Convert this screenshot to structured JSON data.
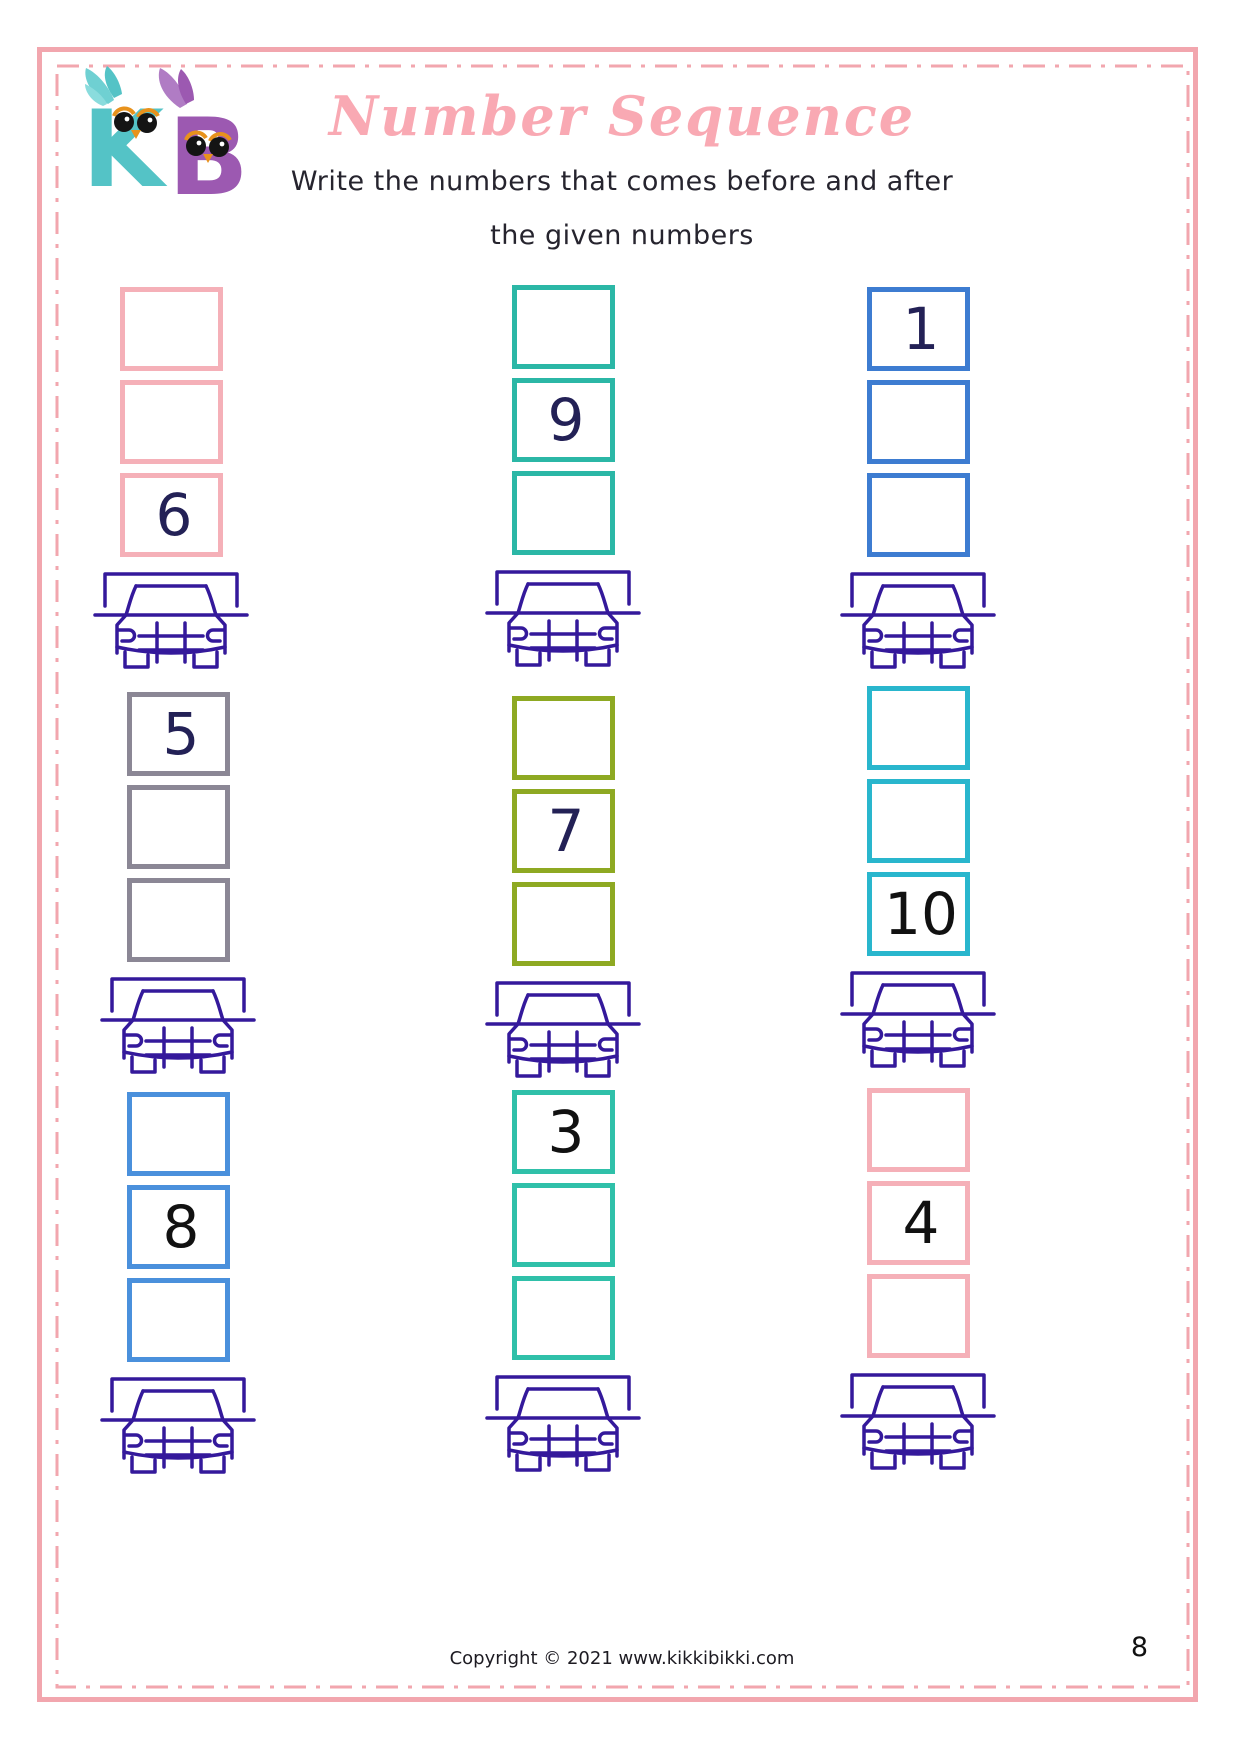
{
  "page": {
    "title": "Number Sequence",
    "instruction_line1": "Write the numbers that comes before and after",
    "instruction_line2": "the given numbers",
    "footer": "Copyright © 2021 www.kikkibikki.com",
    "page_number": "8",
    "border_color": "#f2a6ae",
    "title_color": "#f9a9b3"
  },
  "logo": {
    "text": "KB",
    "k_color": "#54c3c6",
    "b_color": "#9c59b1",
    "beak_color": "#e8921c"
  },
  "car_color": "#34199b",
  "puzzles": [
    {
      "box_color": "#f5b0b8",
      "number_color": "#232156",
      "cells": [
        "",
        "",
        "6"
      ]
    },
    {
      "box_color": "#2bb7a6",
      "number_color": "#232156",
      "cells": [
        "",
        "9",
        ""
      ]
    },
    {
      "box_color": "#3d7cd1",
      "number_color": "#232156",
      "cells": [
        "1",
        "",
        ""
      ]
    },
    {
      "box_color": "#8b8795",
      "number_color": "#232156",
      "cells": [
        "5",
        "",
        ""
      ]
    },
    {
      "box_color": "#8ea922",
      "number_color": "#232156",
      "cells": [
        "",
        "7",
        ""
      ]
    },
    {
      "box_color": "#29b6cd",
      "number_color": "#111111",
      "cells": [
        "",
        "",
        "10"
      ]
    },
    {
      "box_color": "#4a90dc",
      "number_color": "#111111",
      "cells": [
        "",
        "8",
        ""
      ]
    },
    {
      "box_color": "#2fc0a9",
      "number_color": "#111111",
      "cells": [
        "3",
        "",
        ""
      ]
    },
    {
      "box_color": "#f5b0b8",
      "number_color": "#111111",
      "cells": [
        "",
        "4",
        ""
      ]
    }
  ]
}
